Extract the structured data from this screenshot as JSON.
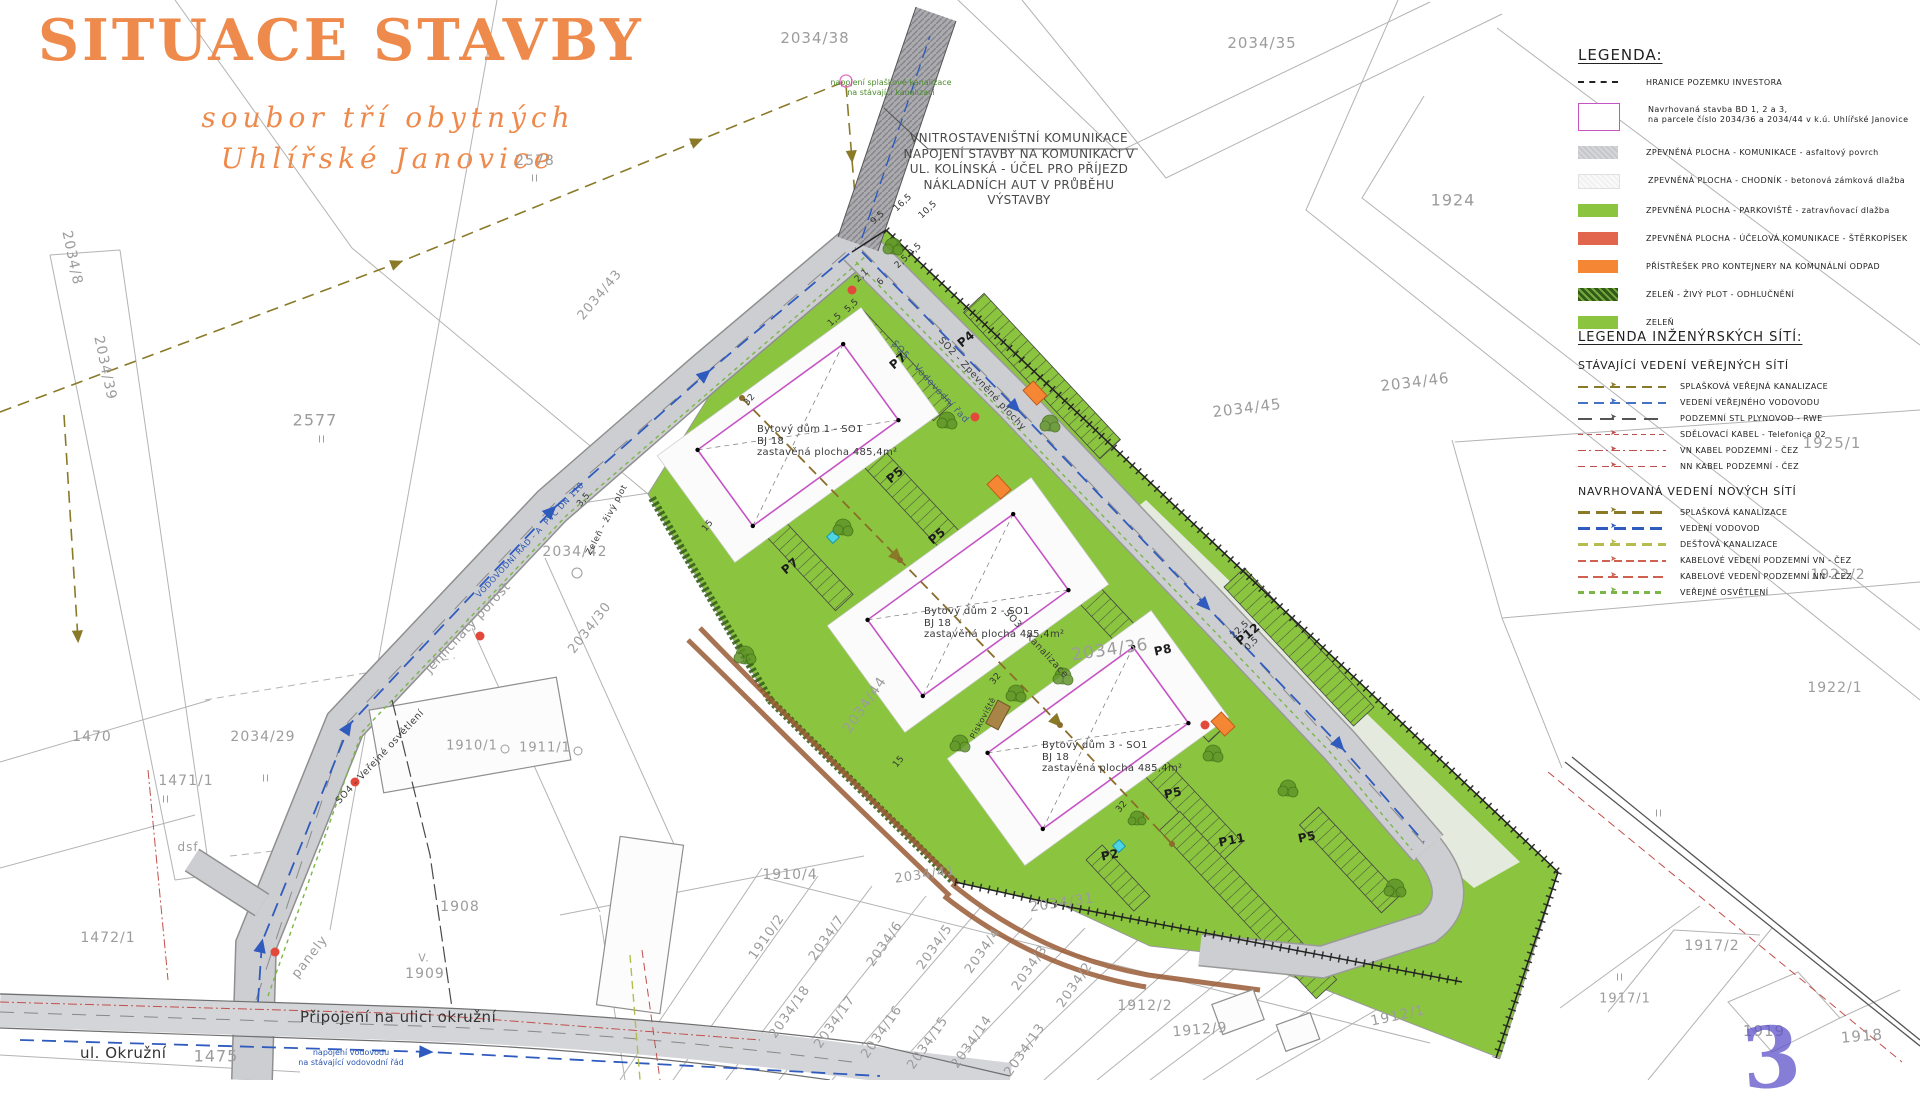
{
  "title": {
    "main": "SITUACE STAVBY",
    "subtitle1": "soubor tří obytných",
    "subtitle2": "Uhlířské Janovice"
  },
  "note_block": {
    "lines": [
      "VNITROSTAVENIŠTNÍ KOMUNIKACE",
      "NAPOJENÍ STAVBY NA KOMUNIKACI V",
      "UL. KOLÍNSKÁ - ÚČEL PRO PŘÍJEZD",
      "NÁKLADNÍCH AUT V PRŮBĚHU",
      "VÝSTAVBY"
    ]
  },
  "legend": {
    "heading": "LEGENDA:",
    "items": [
      {
        "swatch": "dash",
        "label": "HRANICE POZEMKU INVESTORA"
      },
      {
        "swatch": "building",
        "label": "Navrhovaná stavba BD 1, 2 a 3,",
        "label2": "na parcele číslo 2034/36 a 2034/44 v k.ú. Uhlířské Janovice"
      },
      {
        "swatch": "road",
        "label": "ZPEVNĚNÁ PLOCHA  -  KOMUNIKACE  -  asfaltový povrch"
      },
      {
        "swatch": "sidewalk",
        "label": "ZPEVNĚNÁ PLOCHA  -  CHODNÍK  -  betonová zámková dlažba"
      },
      {
        "swatch": "parking",
        "label": "ZPEVNĚNÁ PLOCHA  -  PARKOVIŠTĚ  -  zatravňovací dlažba"
      },
      {
        "swatch": "gravel",
        "label": "ZPEVNĚNÁ PLOCHA  -  ÚČELOVÁ KOMUNIKACE  -  ŠTĚRKOPÍSEK"
      },
      {
        "swatch": "shelter",
        "label": "PŘÍSTŘEŠEK PRO KONTEJNERY NA KOMUNÁLNÍ ODPAD"
      },
      {
        "swatch": "hedge",
        "label": "ZELEŇ  -  ŽIVÝ PLOT  -  ODHLUČNĚNÍ"
      },
      {
        "swatch": "green",
        "label": "ZELEŇ"
      }
    ]
  },
  "utility_legend": {
    "heading": "LEGENDA INŽENÝRSKÝCH SÍTÍ:",
    "existing": {
      "heading": "STÁVAJÍCÍ VEDENÍ VEŘEJNÝCH SÍTÍ",
      "items": [
        {
          "style": "sewer-e",
          "color": "#8a7a28",
          "label": "SPLAŠKOVÁ VEŘEJNÁ KANALIZACE"
        },
        {
          "style": "water-e",
          "color": "#4472c4",
          "label": "VEDENÍ VEŘEJNÉHO VODOVODU"
        },
        {
          "style": "gas",
          "color": "#555555",
          "label": "PODZEMNÍ STL PLYNOVOD  -  RWE"
        },
        {
          "style": "telecom",
          "color": "#c0504d",
          "label": "SDĚLOVACÍ KABEL  -  Telefonica 02"
        },
        {
          "style": "vn",
          "color": "#c0504d",
          "label": "VN KABEL PODZEMNÍ  -  ČEZ"
        },
        {
          "style": "nn",
          "color": "#c0504d",
          "label": "NN KABEL PODZEMNÍ  -  ČEZ"
        }
      ]
    },
    "proposed": {
      "heading": "NAVRHOVANÁ VEDENÍ NOVÝCH SÍTÍ",
      "items": [
        {
          "style": "sewer-n",
          "color": "#8a7a28",
          "label": "SPLAŠKOVÁ KANALIZACE"
        },
        {
          "style": "water-n",
          "color": "#2f5bbf",
          "label": "VEDENÍ VODOVOD"
        },
        {
          "style": "rain",
          "color": "#b5bd4e",
          "label": "DEŠŤOVÁ KANALIZACE"
        },
        {
          "style": "vn-n",
          "color": "#d06050",
          "label": "KABELOVÉ VEDENÍ PODZEMNÍ VN  -  ČEZ"
        },
        {
          "style": "nn-n",
          "color": "#d06050",
          "label": "KABELOVÉ VEDENÍ PODZEMNÍ NN  -  ČEZ"
        },
        {
          "style": "light",
          "color": "#7ab648",
          "label": "VEŘEJNÉ OSVĚTLENÍ"
        }
      ]
    }
  },
  "map": {
    "stamp": "3",
    "street_label": "ul. Okružní",
    "connection_label": "Připojení na ulici okružní",
    "green_note": {
      "lines": [
        "napojení splaškové kanalizace",
        "na stávající kanalizaci"
      ]
    },
    "blue_note": {
      "lines": [
        "napojení vodovodu",
        "na stávající vodovodní řád"
      ]
    },
    "buildings": [
      {
        "name": "Bytový dům 1 - SO1",
        "bj": "BJ 18",
        "area": "zastavěná plocha 485,4m²",
        "x": 757,
        "y": 424
      },
      {
        "name": "Bytový dům 2 - SO1",
        "bj": "BJ 18",
        "area": "zastavěná plocha 485,4m²",
        "x": 924,
        "y": 606
      },
      {
        "name": "Bytový dům 3 - SO1",
        "bj": "BJ 18",
        "area": "zastavěná plocha 485,4m²",
        "x": 1042,
        "y": 740
      }
    ],
    "parcel_labels": [
      {
        "t": "2034/38",
        "x": 815,
        "y": 38,
        "s": 15,
        "r": 0
      },
      {
        "t": "2034/35",
        "x": 1262,
        "y": 43,
        "s": 15,
        "r": 0
      },
      {
        "t": "1924",
        "x": 1453,
        "y": 200,
        "s": 16,
        "r": 0
      },
      {
        "t": "2578",
        "x": 535,
        "y": 161,
        "s": 14,
        "r": 0
      },
      {
        "t": "II",
        "x": 535,
        "y": 179,
        "s": 10,
        "r": 0
      },
      {
        "t": "2577",
        "x": 315,
        "y": 420,
        "s": 16,
        "r": 0
      },
      {
        "t": "II",
        "x": 322,
        "y": 440,
        "s": 10,
        "r": 0
      },
      {
        "t": "2034/8",
        "x": 72,
        "y": 258,
        "s": 14,
        "r": 78
      },
      {
        "t": "2034/39",
        "x": 105,
        "y": 368,
        "s": 14,
        "r": 78
      },
      {
        "t": "2034/43",
        "x": 600,
        "y": 295,
        "s": 13,
        "r": -50
      },
      {
        "t": "2034/46",
        "x": 1415,
        "y": 382,
        "s": 15,
        "r": -7
      },
      {
        "t": "2034/45",
        "x": 1247,
        "y": 408,
        "s": 15,
        "r": -7
      },
      {
        "t": "1925/1",
        "x": 1832,
        "y": 443,
        "s": 15,
        "r": 0
      },
      {
        "t": "1922/2",
        "x": 1838,
        "y": 575,
        "s": 14,
        "r": 0
      },
      {
        "t": "1922/1",
        "x": 1835,
        "y": 688,
        "s": 14,
        "r": 0
      },
      {
        "t": "II",
        "x": 1659,
        "y": 814,
        "s": 10,
        "r": 0
      },
      {
        "t": "2034/42",
        "x": 575,
        "y": 552,
        "s": 14,
        "r": 0
      },
      {
        "t": "1470",
        "x": 92,
        "y": 737,
        "s": 14,
        "r": 0
      },
      {
        "t": "1471/1",
        "x": 186,
        "y": 781,
        "s": 14,
        "r": 0
      },
      {
        "t": "2034/29",
        "x": 263,
        "y": 737,
        "s": 14,
        "r": 0
      },
      {
        "t": "dsf.",
        "x": 190,
        "y": 847,
        "s": 12,
        "r": 0
      },
      {
        "t": "II",
        "x": 266,
        "y": 779,
        "s": 10,
        "r": 0
      },
      {
        "t": "II",
        "x": 166,
        "y": 800,
        "s": 10,
        "r": 0
      },
      {
        "t": "1472/1",
        "x": 108,
        "y": 938,
        "s": 14,
        "r": 0
      },
      {
        "t": "panely",
        "x": 310,
        "y": 957,
        "s": 13,
        "r": -52
      },
      {
        "t": "V.",
        "x": 424,
        "y": 958,
        "s": 11,
        "r": 0
      },
      {
        "t": "1909",
        "x": 425,
        "y": 974,
        "s": 14,
        "r": 0
      },
      {
        "t": "1908",
        "x": 460,
        "y": 907,
        "s": 14,
        "r": 0
      },
      {
        "t": "1910/1",
        "x": 472,
        "y": 746,
        "s": 13,
        "r": 0
      },
      {
        "t": "1911/1",
        "x": 545,
        "y": 748,
        "s": 13,
        "r": 0
      },
      {
        "t": "2034/30",
        "x": 590,
        "y": 628,
        "s": 13,
        "r": -52
      },
      {
        "t": "1475",
        "x": 216,
        "y": 1056,
        "s": 16,
        "r": 0
      },
      {
        "t": "1910/4",
        "x": 790,
        "y": 875,
        "s": 14,
        "r": 0
      },
      {
        "t": "1910/2",
        "x": 767,
        "y": 937,
        "s": 13,
        "r": -55
      },
      {
        "t": "2034/7",
        "x": 827,
        "y": 938,
        "s": 13,
        "r": -55
      },
      {
        "t": "2034/6",
        "x": 885,
        "y": 944,
        "s": 13,
        "r": -55
      },
      {
        "t": "2034/5",
        "x": 935,
        "y": 947,
        "s": 13,
        "r": -55
      },
      {
        "t": "2034/4",
        "x": 983,
        "y": 951,
        "s": 13,
        "r": -55
      },
      {
        "t": "2034/3",
        "x": 1030,
        "y": 968,
        "s": 13,
        "r": -55
      },
      {
        "t": "2034/2",
        "x": 1075,
        "y": 985,
        "s": 13,
        "r": -55
      },
      {
        "t": "2034/18",
        "x": 790,
        "y": 1012,
        "s": 13,
        "r": -55
      },
      {
        "t": "2034/17",
        "x": 835,
        "y": 1022,
        "s": 13,
        "r": -55
      },
      {
        "t": "2034/16",
        "x": 882,
        "y": 1032,
        "s": 13,
        "r": -55
      },
      {
        "t": "2034/15",
        "x": 928,
        "y": 1043,
        "s": 13,
        "r": -55
      },
      {
        "t": "2034/14",
        "x": 972,
        "y": 1042,
        "s": 13,
        "r": -55
      },
      {
        "t": "2034/13",
        "x": 1025,
        "y": 1050,
        "s": 13,
        "r": -55
      },
      {
        "t": "2034/41",
        "x": 925,
        "y": 875,
        "s": 13,
        "r": -8
      },
      {
        "t": "2034/31",
        "x": 1062,
        "y": 903,
        "s": 14,
        "r": -8
      },
      {
        "t": "2034/36",
        "x": 1110,
        "y": 650,
        "s": 17,
        "r": -8
      },
      {
        "t": "2034/44",
        "x": 865,
        "y": 705,
        "s": 14,
        "r": -55
      },
      {
        "t": "1912/2",
        "x": 1145,
        "y": 1006,
        "s": 14,
        "r": 0
      },
      {
        "t": "1912/9",
        "x": 1200,
        "y": 1030,
        "s": 14,
        "r": -5
      },
      {
        "t": "1912/1",
        "x": 1398,
        "y": 1016,
        "s": 14,
        "r": -12
      },
      {
        "t": "1917/2",
        "x": 1712,
        "y": 946,
        "s": 14,
        "r": 0
      },
      {
        "t": "II",
        "x": 1620,
        "y": 978,
        "s": 10,
        "r": 0
      },
      {
        "t": "1917/1",
        "x": 1625,
        "y": 999,
        "s": 13,
        "r": 0
      },
      {
        "t": "1919",
        "x": 1764,
        "y": 1031,
        "s": 15,
        "r": 0
      },
      {
        "t": "1918",
        "x": 1862,
        "y": 1036,
        "s": 15,
        "r": -5
      }
    ],
    "parking_labels": [
      {
        "t": "P4",
        "x": 966,
        "y": 339,
        "s": 12,
        "r": -40
      },
      {
        "t": "P7",
        "x": 898,
        "y": 361,
        "s": 12,
        "r": -40
      },
      {
        "t": "P5",
        "x": 895,
        "y": 475,
        "s": 12,
        "r": -40
      },
      {
        "t": "P5",
        "x": 937,
        "y": 536,
        "s": 12,
        "r": -40
      },
      {
        "t": "P7",
        "x": 790,
        "y": 566,
        "s": 12,
        "r": -40
      },
      {
        "t": "P8",
        "x": 1163,
        "y": 650,
        "s": 12,
        "r": -12
      },
      {
        "t": "P12",
        "x": 1248,
        "y": 634,
        "s": 12,
        "r": -40
      },
      {
        "t": "P5",
        "x": 1173,
        "y": 793,
        "s": 12,
        "r": -12
      },
      {
        "t": "P2",
        "x": 1110,
        "y": 855,
        "s": 12,
        "r": -12
      },
      {
        "t": "P11",
        "x": 1232,
        "y": 840,
        "s": 12,
        "r": -12
      },
      {
        "t": "P5",
        "x": 1307,
        "y": 837,
        "s": 12,
        "r": -12
      }
    ],
    "dim_labels": [
      {
        "t": "0,5",
        "x": 915,
        "y": 250,
        "s": 9,
        "r": -43
      },
      {
        "t": "2,5",
        "x": 902,
        "y": 262,
        "s": 9,
        "r": -43
      },
      {
        "t": "6",
        "x": 881,
        "y": 282,
        "s": 9,
        "r": -43
      },
      {
        "t": "2,1",
        "x": 862,
        "y": 276,
        "s": 9,
        "r": -43
      },
      {
        "t": "5,5",
        "x": 852,
        "y": 306,
        "s": 9,
        "r": -43
      },
      {
        "t": "1,5",
        "x": 835,
        "y": 320,
        "s": 9,
        "r": -43
      },
      {
        "t": "16,5",
        "x": 903,
        "y": 203,
        "s": 9,
        "r": -43
      },
      {
        "t": "10,5",
        "x": 928,
        "y": 210,
        "s": 9,
        "r": -43
      },
      {
        "t": "9,5",
        "x": 878,
        "y": 218,
        "s": 9,
        "r": -43
      },
      {
        "t": "32",
        "x": 750,
        "y": 400,
        "s": 9,
        "r": -50
      },
      {
        "t": "15",
        "x": 708,
        "y": 526,
        "s": 9,
        "r": -50
      },
      {
        "t": "3,5",
        "x": 584,
        "y": 500,
        "s": 9,
        "r": -50
      },
      {
        "t": "32",
        "x": 996,
        "y": 679,
        "s": 9,
        "r": -50
      },
      {
        "t": "15",
        "x": 899,
        "y": 762,
        "s": 9,
        "r": -50
      },
      {
        "t": "32",
        "x": 1122,
        "y": 807,
        "s": 9,
        "r": -50
      },
      {
        "t": "22,5",
        "x": 1240,
        "y": 630,
        "s": 9,
        "r": -43
      },
      {
        "t": "0,5",
        "x": 1252,
        "y": 644,
        "s": 9,
        "r": -43
      }
    ],
    "road_labels": [
      {
        "t": "SO2 - Zpevněné plochy",
        "x": 982,
        "y": 384,
        "s": 9.5,
        "r": 47,
        "c": "#3a3a3a"
      },
      {
        "t": "SO5 - Vodovodní řad",
        "x": 930,
        "y": 382,
        "s": 9.5,
        "r": 47,
        "c": "#44608a"
      },
      {
        "t": "SO3 - Kanalizace",
        "x": 1036,
        "y": 644,
        "s": 9.5,
        "r": 47,
        "c": "#3a3a3a"
      },
      {
        "t": "SO4 - Veřejné osvětlení",
        "x": 380,
        "y": 757,
        "s": 9.5,
        "r": -47,
        "c": "#3a3a3a"
      },
      {
        "t": "VODOVODNÍ ŘÁD - A  PVC DN 110",
        "x": 530,
        "y": 540,
        "s": 8,
        "r": -47,
        "c": "#2a56b0"
      },
      {
        "t": "jehličnatý porost",
        "x": 468,
        "y": 628,
        "s": 13,
        "r": -47,
        "c": "#9a9a9a"
      },
      {
        "t": "Zeleň - živý plot",
        "x": 607,
        "y": 520,
        "s": 8.5,
        "r": -62,
        "c": "#333333"
      },
      {
        "t": "Pískoviště",
        "x": 983,
        "y": 718,
        "s": 8,
        "r": -62,
        "c": "#333333"
      }
    ]
  },
  "colors": {
    "accent": "#ee8a4c",
    "green": "#8bc53f",
    "gravel": "#e2654e",
    "shelter": "#f58634",
    "building_outline": "#c554c5",
    "water": "#2f5bbf",
    "sewer": "#8a7a28",
    "cable": "#c0504d",
    "light": "#7ab648",
    "road": "#cdced1",
    "stamp": "#5c52c8"
  }
}
